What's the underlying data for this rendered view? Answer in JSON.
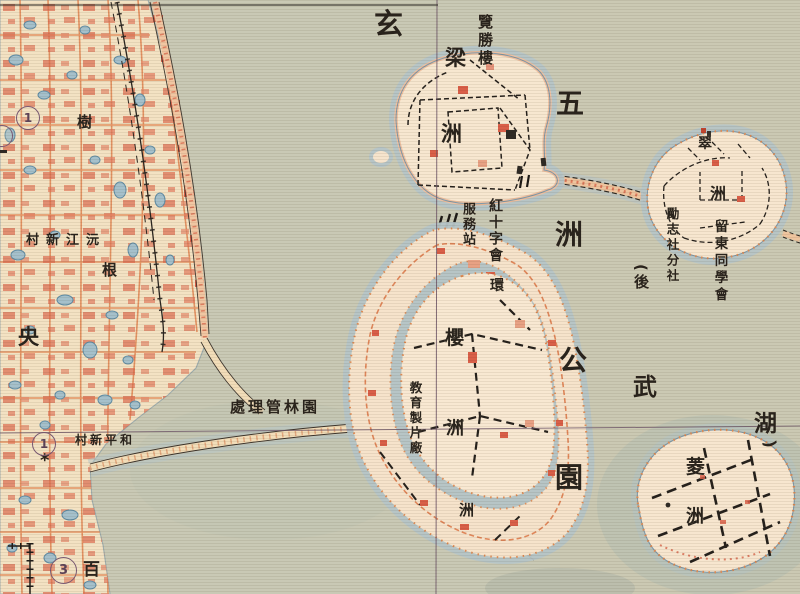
{
  "map_type": "historical scanned park map (Xuanwu Lake / Five-Isles Park area)",
  "colors": {
    "paper_city": "#f3e2c3",
    "water_base": "#c9c9b5",
    "water_blue": "#b7c5c7",
    "island_fill": "#f6e4cd",
    "shore_band_pink": "#efc0a0",
    "street_orange": "#e18a58",
    "building_red": "#db6a4e",
    "dashed_path_black": "#26211c",
    "grid_line_purple": "#6d5566",
    "shore_dot_orange": "#de8a52",
    "text_ink": "#2a241d",
    "marker_purple": "#7a5a74"
  },
  "lake": {
    "xuan": "玄",
    "wu": "武",
    "hu": "湖",
    "alt_prefix": "(後",
    "alt_close": ")"
  },
  "park": {
    "chars": [
      "五",
      "洲",
      "公",
      "園"
    ]
  },
  "islands": {
    "liangzhou": [
      "梁",
      "洲"
    ],
    "cuizhou": [
      "翠",
      "洲"
    ],
    "huanzhou": [
      "環",
      "洲"
    ],
    "yingzhou": [
      "櫻",
      "洲"
    ],
    "lingzhou": [
      "菱",
      "洲"
    ]
  },
  "pois": {
    "lanshenglou": "覽勝樓",
    "red_cross_line1": "紅十字會",
    "red_cross_line2": "服務站",
    "lizhishe_branch": "勵志社分社",
    "liudong_assoc": "留東同學會",
    "edu_film_studio": "教育製片廠",
    "park_admin_office_rtl": "處理管林園",
    "yuanjiang_village_rtl": "村新江沅",
    "heping_village_rtl": "村新平和",
    "yang_char": "央",
    "shu_char": "樹",
    "gen_char": "根",
    "bai_char": "百"
  },
  "markers": {
    "circled_1a": "1",
    "circled_1b": "1",
    "circled_3": "3",
    "star": "*"
  }
}
